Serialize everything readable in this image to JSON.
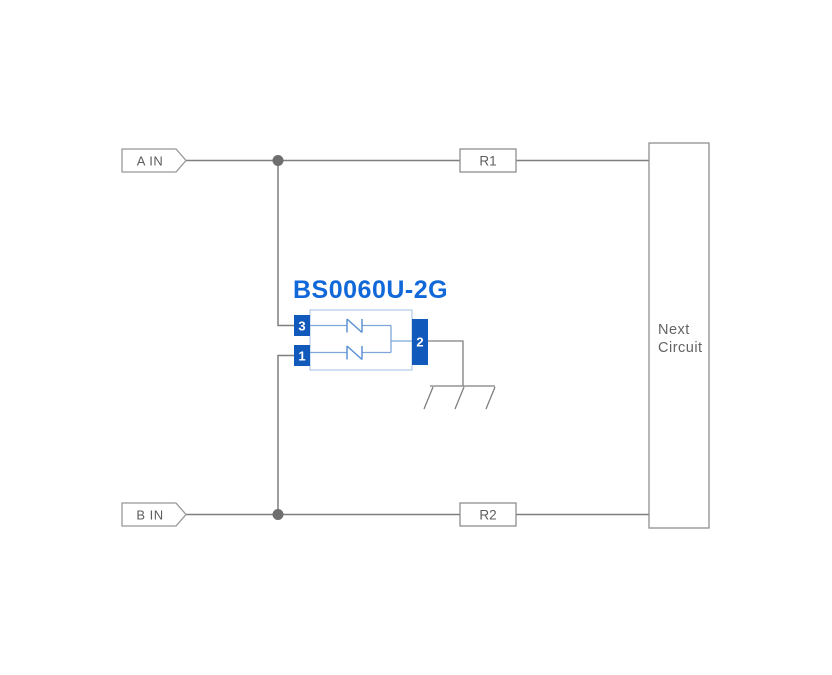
{
  "schematic": {
    "component": {
      "title": "BS0060U-2G",
      "pins": {
        "p1": "1",
        "p2": "2",
        "p3": "3"
      }
    },
    "ports": {
      "a": "A IN",
      "b": "B IN"
    },
    "resistors": {
      "r1": "R1",
      "r2": "R2"
    },
    "next_circuit": {
      "line1": "Next",
      "line2": "Circuit"
    },
    "colors": {
      "wire_gray": "#7f7f7f",
      "junction_gray": "#6e6e6e",
      "box_border_gray": "#8f8f8f",
      "label_gray": "#5d5d5d",
      "title_blue": "#1168d8",
      "pin_blue": "#1159bb",
      "body_outline_blue": "#b0cbe9",
      "inner_wire_blue": "#7ea6da",
      "symbol_blue": "#5d92d3",
      "background": "#ffffff"
    }
  }
}
